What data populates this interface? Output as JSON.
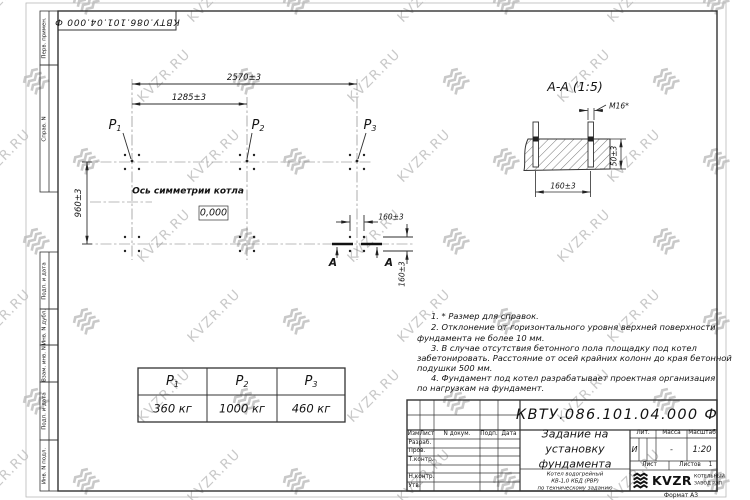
{
  "stamp_number": "КВТУ.086.101.04.000  Ф",
  "watermark": {
    "text": "KVZR.RU"
  },
  "colors": {
    "line": "#2e2e2e",
    "axis": "#787878",
    "watermark": "#c9c9c9"
  },
  "margin_labels": {
    "perv_primen": "Перв. примен.",
    "sprav_n": "Справ. N",
    "podp_data_1": "Подп. и дата",
    "inv_n_dubl": "Инв. N дубл.",
    "vzam_inv_n": "Взам. инв. N",
    "podp_data_2": "Подп. и дата",
    "inv_n_podl": "Инв. N подл."
  },
  "plan": {
    "dim_width_total": "2570±3",
    "dim_width_half": "1285±3",
    "dim_height": "960±3",
    "dim_bolt_h": "160±3",
    "dim_bolt_v": "160±3",
    "axis_label": "Ось симметрии котла",
    "elevation_mark": "0,000",
    "p_labels": [
      {
        "base": "P",
        "sub": "1"
      },
      {
        "base": "P",
        "sub": "2"
      },
      {
        "base": "P",
        "sub": "3"
      }
    ],
    "section_letters": [
      "А",
      "А"
    ]
  },
  "section": {
    "title": "А-А (1:5)",
    "bolt_thread": "М16*",
    "dim_height": "50±3",
    "dim_spacing": "160±3"
  },
  "load_table": {
    "columns": [
      {
        "base": "P",
        "sub": "1",
        "value": "360 кг"
      },
      {
        "base": "P",
        "sub": "2",
        "value": "1000 кг"
      },
      {
        "base": "P",
        "sub": "3",
        "value": "460 кг"
      }
    ]
  },
  "notes_lines": [
    "1. * Размер для справок.",
    "2. Отклонение от горизонтального уровня верхней поверхности",
    "фундамента не более 10 мм.",
    "3. В случае отсутствия бетонного пола площадку под котел",
    "забетонировать. Расстояние от осей крайних колонн до края бетонной",
    "подушки 500 мм.",
    "4. Фундамент под котел разрабатывает проектная организация",
    "по нагрузкам на фундамент."
  ],
  "title_block": {
    "doc_number": "КВТУ.086.101.04.000  Ф",
    "title_line1": "Задание на",
    "title_line2": "установку",
    "title_line3": "фундамента",
    "subtitle_line1": "Котел водогрейный",
    "subtitle_line2": "КВ-1,0 КБД (РВР)",
    "subtitle_line3": "по техническому заданию",
    "col_izm": "Изм",
    "col_list": "Лист",
    "col_ndokum": "N докум.",
    "col_podp": "Подп.",
    "col_data": "Дата",
    "row_razrab": "Разраб.",
    "row_prov": "Пров.",
    "row_tkontr": "Т.контр.",
    "row_nkontr": "Н.контр.",
    "row_utv": "Утв.",
    "lit_header": "Лит.",
    "mass_header": "Масса",
    "scale_header": "Масштаб",
    "lit_value": "И",
    "mass_value": "-",
    "scale_value": "1:20",
    "sheet_label": "Лист",
    "sheets_label": "Листов",
    "sheets_value": "1",
    "company_name": "KVZR",
    "company_sub1": "КОТЕЛЬНЫЙ",
    "company_sub2": "ЗАВОД РЭП",
    "format_label": "Формат А3"
  }
}
